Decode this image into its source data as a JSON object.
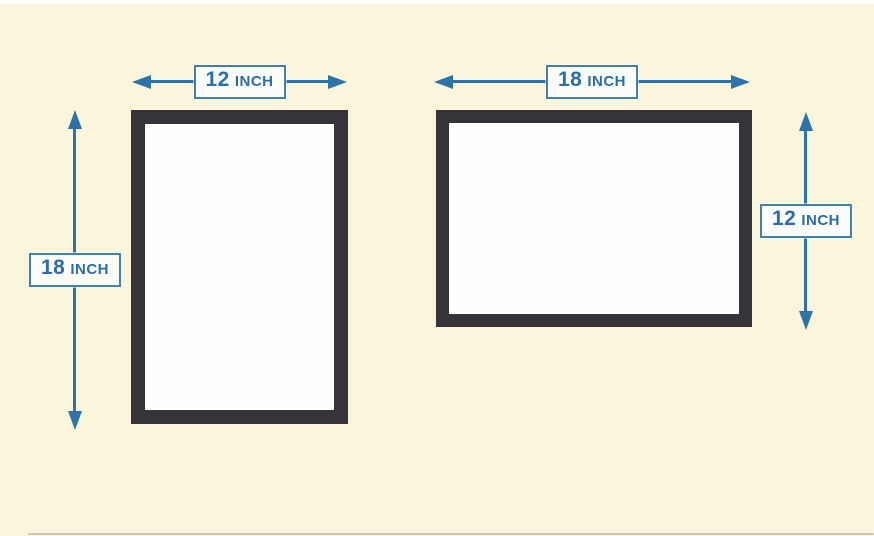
{
  "title": "Frame size comparison diagram",
  "colors": {
    "background": "#f9f6dc",
    "frame_border": "#36343a",
    "frame_fill": "#fdfdfc",
    "arrow": "#2d72a8",
    "label_text": "#2a6da7",
    "label_border": "#4180a9",
    "label_fill": "#fcfdf8"
  },
  "frames": {
    "portrait": {
      "width": {
        "number": "12",
        "unit": "INCH"
      },
      "height": {
        "number": "18",
        "unit": "INCH"
      }
    },
    "landscape": {
      "width": {
        "number": "18",
        "unit": "INCH"
      },
      "height": {
        "number": "12",
        "unit": "INCH"
      }
    }
  }
}
